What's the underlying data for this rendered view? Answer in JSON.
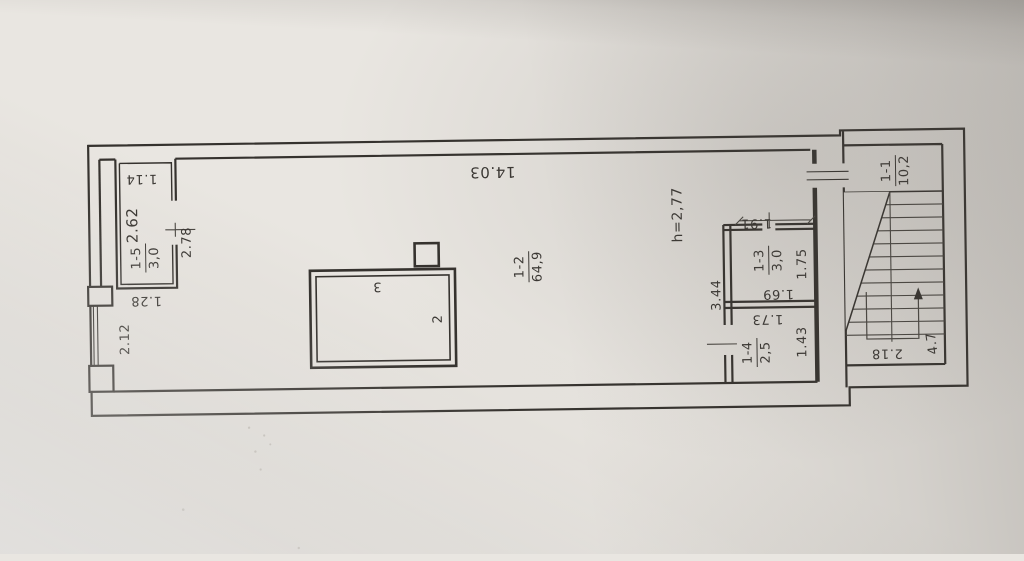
{
  "document": {
    "kind": "scanned floor plan photograph",
    "floor_note": "single storey plan with stairwell"
  },
  "rooms": {
    "stairwell": {
      "code": "1-1",
      "area": "10,2"
    },
    "main_hall": {
      "code": "1-2",
      "area": "64,9"
    },
    "room_1_3": {
      "code": "1-3",
      "area": "3,0"
    },
    "room_1_4": {
      "code": "1-4",
      "area": "2,5"
    },
    "room_1_5": {
      "code": "1-5",
      "area": "3,0"
    }
  },
  "dimensions": {
    "hall_width": "14.03",
    "ceiling_height": "h=2,77",
    "dim_1_91": "1.91",
    "dim_1_75": "1.75",
    "dim_1_69": "1.69",
    "dim_3_44": "3.44",
    "dim_1_73": "1.73",
    "dim_1_43": "1.43",
    "dim_2_18": "2.18",
    "dim_4_7": "4.7",
    "dim_1_14": "1.14",
    "dim_2_62": "2.62",
    "dim_2_78": "2.78",
    "dim_1_28": "1.28",
    "dim_2_12": "2.12"
  },
  "markers": {
    "pos_2": "2",
    "pos_3": "3"
  },
  "colors": {
    "ink": "#35322e",
    "paper": "#e9e6e1"
  }
}
